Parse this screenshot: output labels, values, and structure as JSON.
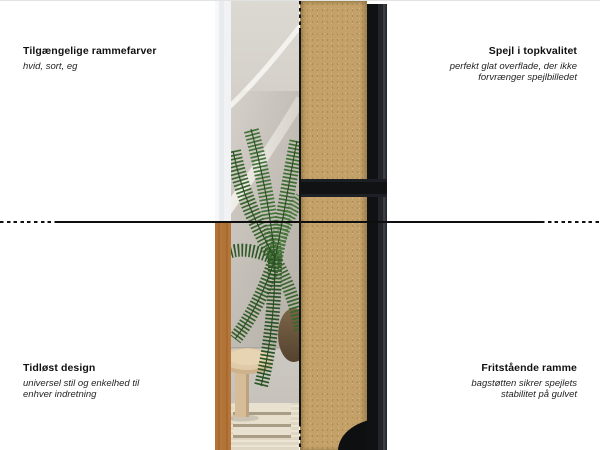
{
  "figure": {
    "type": "product-feature-infographic",
    "subject": "fritstaaende spejl (free-standing mirror), front/back split view",
    "language": "da"
  },
  "annotations": {
    "top_left": {
      "title": "Tilgængelige rammefarver",
      "subtitle_lines": [
        "hvid, sort, eg"
      ]
    },
    "top_right": {
      "title": "Spejl i topkvalitet",
      "subtitle_lines": [
        "perfekt glat overflade, der ikke",
        "forvrænger spejlbilledet"
      ]
    },
    "bottom_left": {
      "title": "Tidløst design",
      "subtitle_lines": [
        "universel stil og enkelhed til",
        "enhver indretning"
      ]
    },
    "bottom_right": {
      "title": "Fritstående ramme",
      "subtitle_lines": [
        "bagstøtten sikrer spejlets",
        "stabilitet på gulvet"
      ]
    }
  },
  "colors": {
    "background": "#ffffff",
    "annotation_line": "#111111",
    "frame_black": "#17191c",
    "frame_white": "#eef0f2",
    "frame_oak": "#d2a873",
    "mdf_back": "#c3a168",
    "wall_beige": "#d3cfc8",
    "plant_green": "#3f6f33"
  }
}
